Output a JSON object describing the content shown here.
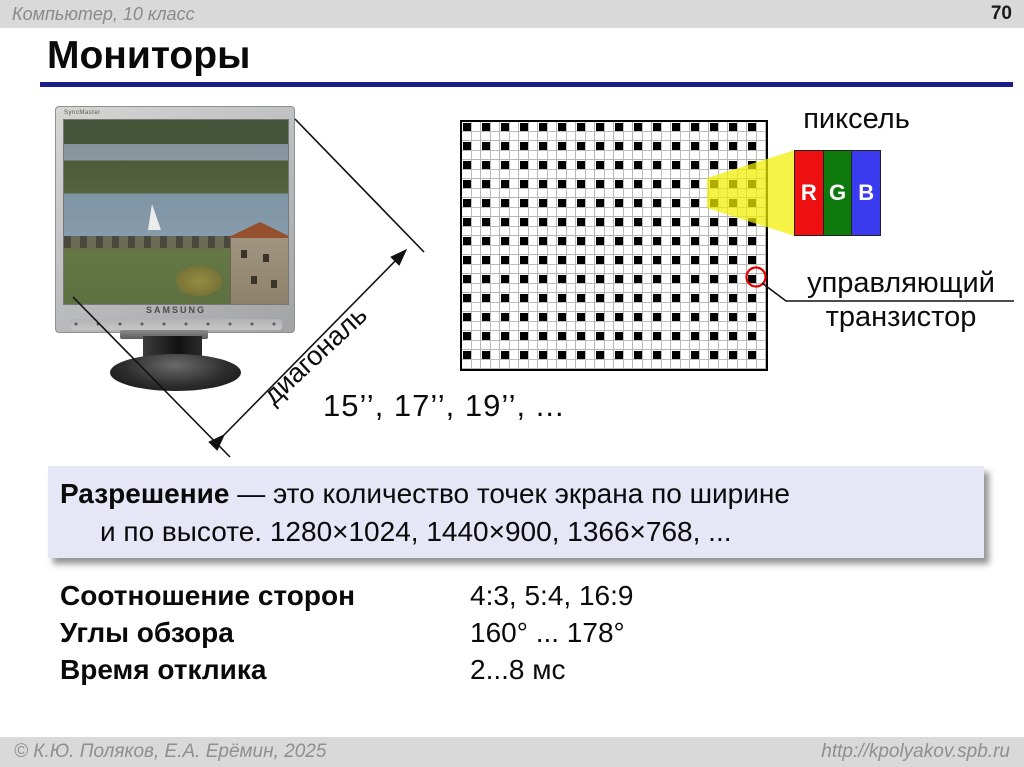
{
  "header": {
    "course": "Компьютер, 10 класс",
    "page": "70"
  },
  "title": "Мониторы",
  "monitor": {
    "brand": "SAMSUNG",
    "model_label": "SyncMaster"
  },
  "diagram": {
    "pixel_label": "пиксель",
    "transistor_line1": "управляющий",
    "transistor_line2": "транзистор",
    "diagonal_label": "диагональ",
    "sizes": "15’’, 17’’, 19’’, ...",
    "rgb": [
      {
        "letter": "R",
        "color": "#ee1010"
      },
      {
        "letter": "G",
        "color": "#0e7a0e"
      },
      {
        "letter": "B",
        "color": "#3a3aee"
      }
    ],
    "grid": {
      "cols": 16,
      "rows": 13
    }
  },
  "resolution": {
    "term": "Разрешение",
    "definition": " — это количество точек экрана по ширине",
    "line2": "и по высоте.  1280×1024, 1440×900, 1366×768, ..."
  },
  "specs": {
    "rows": [
      {
        "label": "Соотношение сторон",
        "value": "4:3, 5:4, 16:9"
      },
      {
        "label": "Углы обзора",
        "value": "160° ... 178°"
      },
      {
        "label": "Время отклика",
        "value": "2...8 мс"
      }
    ]
  },
  "footer": {
    "copyright": "© К.Ю. Поляков, Е.А. Ерёмин, 2025",
    "url": "http://kpolyakov.spb.ru"
  },
  "colors": {
    "accent_underline": "#1c1c8a",
    "box_bg": "#e6e6f7",
    "highlight_yellow": "#f2ee00"
  }
}
